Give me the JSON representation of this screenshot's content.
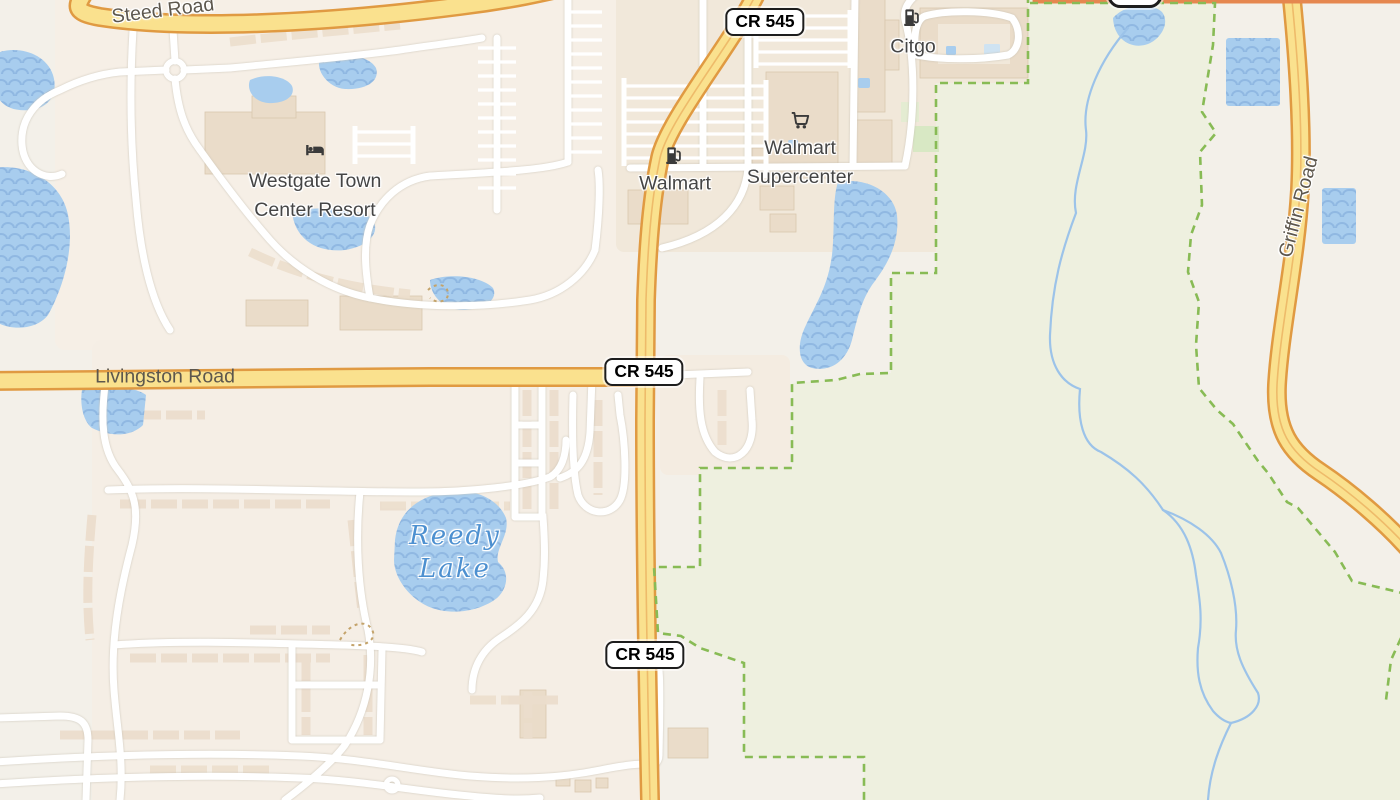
{
  "map": {
    "kind": "street-map-view",
    "road_labels": {
      "steed": "Steed Road",
      "livingston": "Livingston Road",
      "griffin": "Griffin Road"
    },
    "water_labels": {
      "reedy_line1": "Reedy",
      "reedy_line2": "Lake"
    },
    "poi_labels": {
      "westgate_line1": "Westgate Town",
      "westgate_line2": "Center Resort",
      "walmart_fuel": "Walmart",
      "walmart_super_line1": "Walmart",
      "walmart_super_line2": "Supercenter",
      "citgo": "Citgo"
    },
    "shields": {
      "cr545": "CR 545",
      "us192": "192"
    },
    "icons": [
      "fuel-icon",
      "shopping-cart-icon",
      "lodging-icon"
    ],
    "colors": {
      "background": "#f3f0e9",
      "residential": "#f6efe6",
      "commercial": "#f1e8da",
      "park_green": "#eef0df",
      "park_boundary_dash": "#88bb55",
      "water": "#a8cdee",
      "water_wave": "#90b8e2",
      "stream": "#9cc3e9",
      "minor_road": "#ffffff",
      "secondary_road_fill": "#fae18e",
      "secondary_road_casing": "#e09a42",
      "primary_road": "#e5874f",
      "building": "#eadcc9",
      "label_gray": "#454545",
      "road_label": "#5d574d",
      "water_label": "#4d90d0"
    }
  }
}
